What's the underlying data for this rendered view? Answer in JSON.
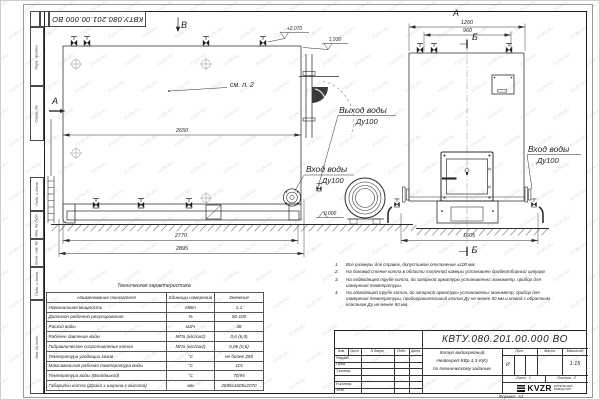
{
  "watermark": {
    "text": "KVZR.RU"
  },
  "doc_number": "КВТУ.080.201.00.000  ВО",
  "frame_labels": [
    "Перв. примен.",
    "Справ. №",
    "Подп. и дата",
    "Инв. № дубл.",
    "Взам. инв. №",
    "Подп. и дата",
    "Инв. № подл."
  ],
  "drawing": {
    "view_labels": {
      "a_side": "А",
      "a_front": "А",
      "b_view": "В",
      "b_section_top": "Б",
      "b_section_bottom": "Б"
    },
    "see_note": "см. п. 2",
    "elevations": {
      "valve_top": "+2,070",
      "boiler_top": "1,930",
      "ground": "0.000"
    },
    "dimensions": {
      "d2650": "2650",
      "d2770": "2770",
      "d2895": "2895",
      "d1260": "1260",
      "d960": "960",
      "d1605": "1605"
    },
    "ports": {
      "outlet": {
        "line1": "Выход воды",
        "line2": "Ду100"
      },
      "inlet_side": {
        "line1": "Вход воды",
        "line2": "Ду100"
      },
      "inlet_front": {
        "line1": "Вход воды",
        "line2": "Ду100"
      }
    }
  },
  "table": {
    "title": "Техническая характеристика",
    "headers": [
      "Наименование показателя",
      "Единицы измерения",
      "Значение"
    ],
    "rows": [
      [
        "Номинальная мощность",
        "МВт",
        "1,1"
      ],
      [
        "Диапазон рабочего регулирования",
        "%",
        "50-100"
      ],
      [
        "Расход воды",
        "м3/ч",
        "38"
      ],
      [
        "Рабочее давление воды",
        "МПа (кгс/см2)",
        "0,6 (6,0)"
      ],
      [
        "Гидравлическое сопротивление котла",
        "МПа (кгс/см2)",
        "0,06 (0,6)"
      ],
      [
        "Температура уходящих газов",
        "°С",
        "не более 250"
      ],
      [
        "Максимальная рабочая температура воды",
        "°С",
        "115"
      ],
      [
        "Температура воды (Вход/выход)",
        "°С",
        "70/95"
      ],
      [
        "Габариты котла (Длина х ширина х высота)",
        "мм",
        "2895х1605х2070"
      ]
    ]
  },
  "notes": {
    "items": [
      {
        "num": "1.",
        "text": "Все размеры для справок, допустимое отклонение ±100 мм."
      },
      {
        "num": "2.",
        "text": "На боковой стенке котла в области топочной камеры установлен дробеотборный штуцер"
      },
      {
        "num": "3.",
        "text": "На подводящей трубе котла, до запорной арматуры установлены: манометр, прибор для измерения температуры."
      },
      {
        "num": "4.",
        "text": "На отводящей трубе котла, до запорной арматуры установлены: манометр, прибор для измерения температуры, предохранительный клапан Ду не менее 50 мм и отвод с обратным клапаном Ду не менее 50 мм."
      }
    ]
  },
  "title_block": {
    "header_cells": [
      "Изм.",
      "Лист",
      "N докум.",
      "Подп.",
      "Дата"
    ],
    "row_labels": [
      "Разраб.",
      "Пров.",
      "Т.контр.",
      "Н.контр.",
      "Утв."
    ],
    "title_line1": "Котел водогрейный",
    "title_line2": "Heatexpert-КВр-1,1-К(К)",
    "title_line3": "по техническому заданию",
    "lit_label": "Лит.",
    "lit_value": "И",
    "mass_label": "Масса",
    "scale_label": "Масштаб",
    "scale_value": "1:15",
    "sheet_label": "Лист",
    "sheet_value": "1",
    "sheets_label": "Листов",
    "sheets_value": "2",
    "logo_text": "KVZR",
    "logo_sub1": "КОТЕЛЬНЫЙ",
    "logo_sub2": "ЗАВОД РЭП",
    "format_label": "Формат",
    "format_value": "А3"
  }
}
